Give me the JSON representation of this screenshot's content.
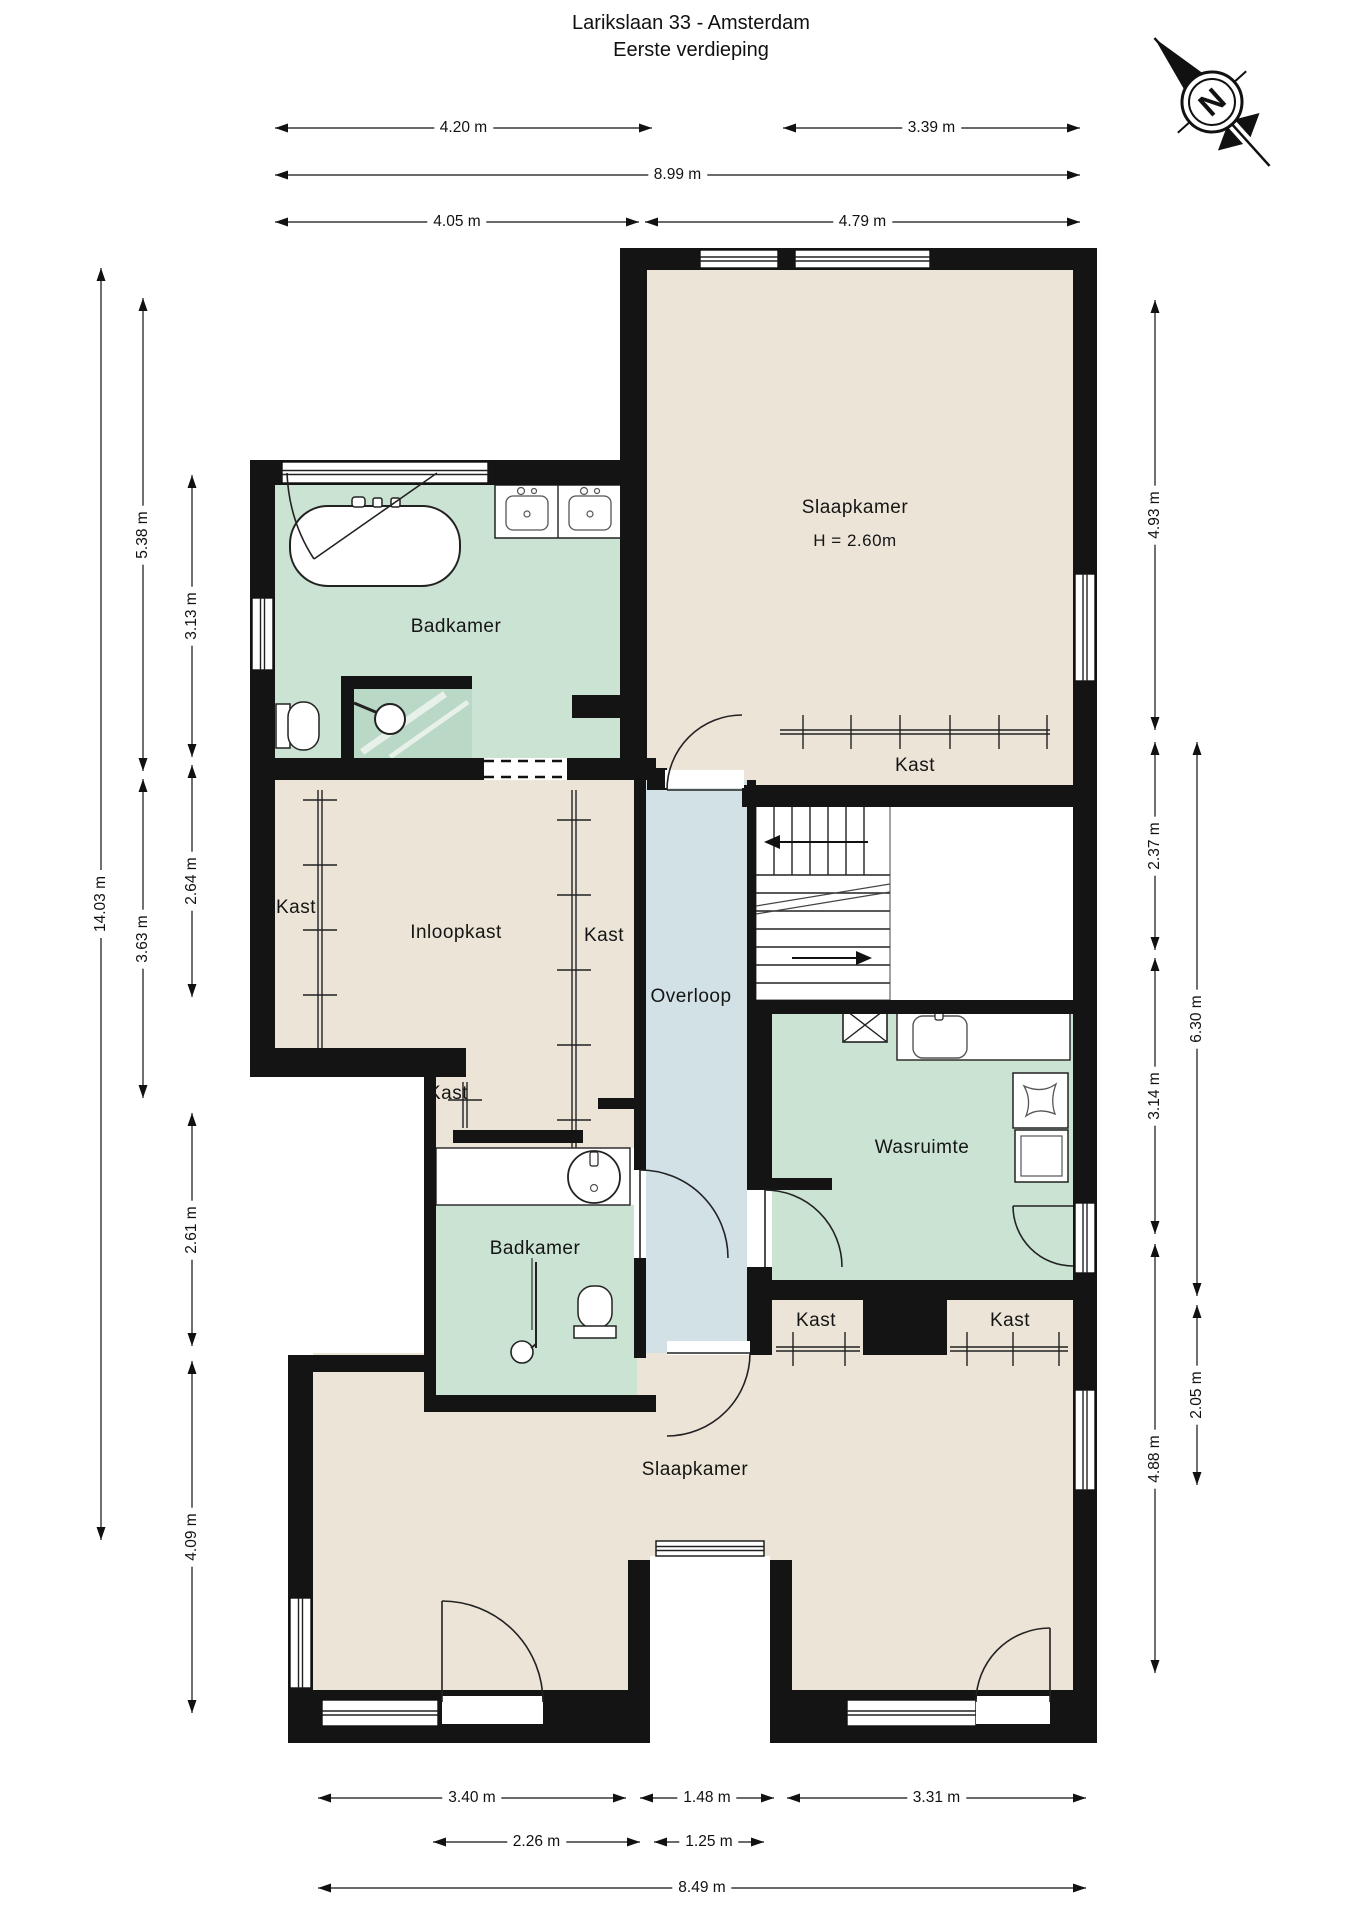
{
  "title": {
    "line1": "Larikslaan 33 - Amsterdam",
    "line2": "Eerste verdieping"
  },
  "compass": {
    "letter": "N"
  },
  "palette": {
    "beige": "#ece4d7",
    "green": "#cbe3d3",
    "green_dark": "#b9d8c6",
    "blue": "#d2e1e6",
    "wall": "#141414",
    "line": "#222222",
    "white": "#ffffff"
  },
  "room_labels": [
    {
      "id": "slaapkamer-1",
      "text": "Slaapkamer"
    },
    {
      "id": "slaapkamer-1-height",
      "text": "H = 2.60m"
    },
    {
      "id": "badkamer-1",
      "text": "Badkamer"
    },
    {
      "id": "kast-bedroom-1",
      "text": "Kast"
    },
    {
      "id": "inloopkast",
      "text": "Inloopkast"
    },
    {
      "id": "kast-left",
      "text": "Kast"
    },
    {
      "id": "kast-mid",
      "text": "Kast"
    },
    {
      "id": "kast-small",
      "text": "Kast"
    },
    {
      "id": "overloop",
      "text": "Overloop"
    },
    {
      "id": "wasruimte",
      "text": "Wasruimte"
    },
    {
      "id": "badkamer-2",
      "text": "Badkamer"
    },
    {
      "id": "kast-bottom-left",
      "text": "Kast"
    },
    {
      "id": "kast-bottom-right",
      "text": "Kast"
    },
    {
      "id": "slaapkamer-2",
      "text": "Slaapkamer"
    }
  ],
  "dimensions": [
    {
      "id": "t1",
      "label": "4.20 m"
    },
    {
      "id": "t2",
      "label": "3.39 m"
    },
    {
      "id": "t3",
      "label": "8.99 m"
    },
    {
      "id": "t4",
      "label": "4.05 m"
    },
    {
      "id": "t5",
      "label": "4.79 m"
    },
    {
      "id": "b1",
      "label": "3.40 m"
    },
    {
      "id": "b2",
      "label": "1.48 m"
    },
    {
      "id": "b3",
      "label": "3.31 m"
    },
    {
      "id": "b4",
      "label": "2.26 m"
    },
    {
      "id": "b5",
      "label": "1.25 m"
    },
    {
      "id": "b6",
      "label": "8.49 m"
    },
    {
      "id": "l1",
      "label": "14.03 m"
    },
    {
      "id": "l2",
      "label": "5.38 m"
    },
    {
      "id": "l3",
      "label": "3.63 m"
    },
    {
      "id": "l4",
      "label": "3.13 m"
    },
    {
      "id": "l5",
      "label": "2.64 m"
    },
    {
      "id": "l6",
      "label": "2.61 m"
    },
    {
      "id": "l7",
      "label": "4.09 m"
    },
    {
      "id": "r1",
      "label": "4.93 m"
    },
    {
      "id": "r2",
      "label": "2.37 m"
    },
    {
      "id": "r3",
      "label": "3.14 m"
    },
    {
      "id": "r4",
      "label": "4.88 m"
    },
    {
      "id": "r5",
      "label": "6.30 m"
    },
    {
      "id": "r6",
      "label": "2.05 m"
    }
  ],
  "icon_names": {
    "bathtub": "bathtub-icon",
    "vanity_double": "double-sink-vanity-icon",
    "toilet1": "toilet-icon",
    "shower1": "shower-icon",
    "vent": "ventilation-grid-icon",
    "laundry_sink": "laundry-sink-icon",
    "basket": "laundry-basket-icon",
    "washer": "washing-machine-icon",
    "sink2": "round-sink-icon",
    "toilet2": "toilet-icon",
    "shower2": "shower-icon",
    "stairs": "staircase-icon",
    "void": "stairwell-void",
    "compass": "compass-north-icon"
  }
}
